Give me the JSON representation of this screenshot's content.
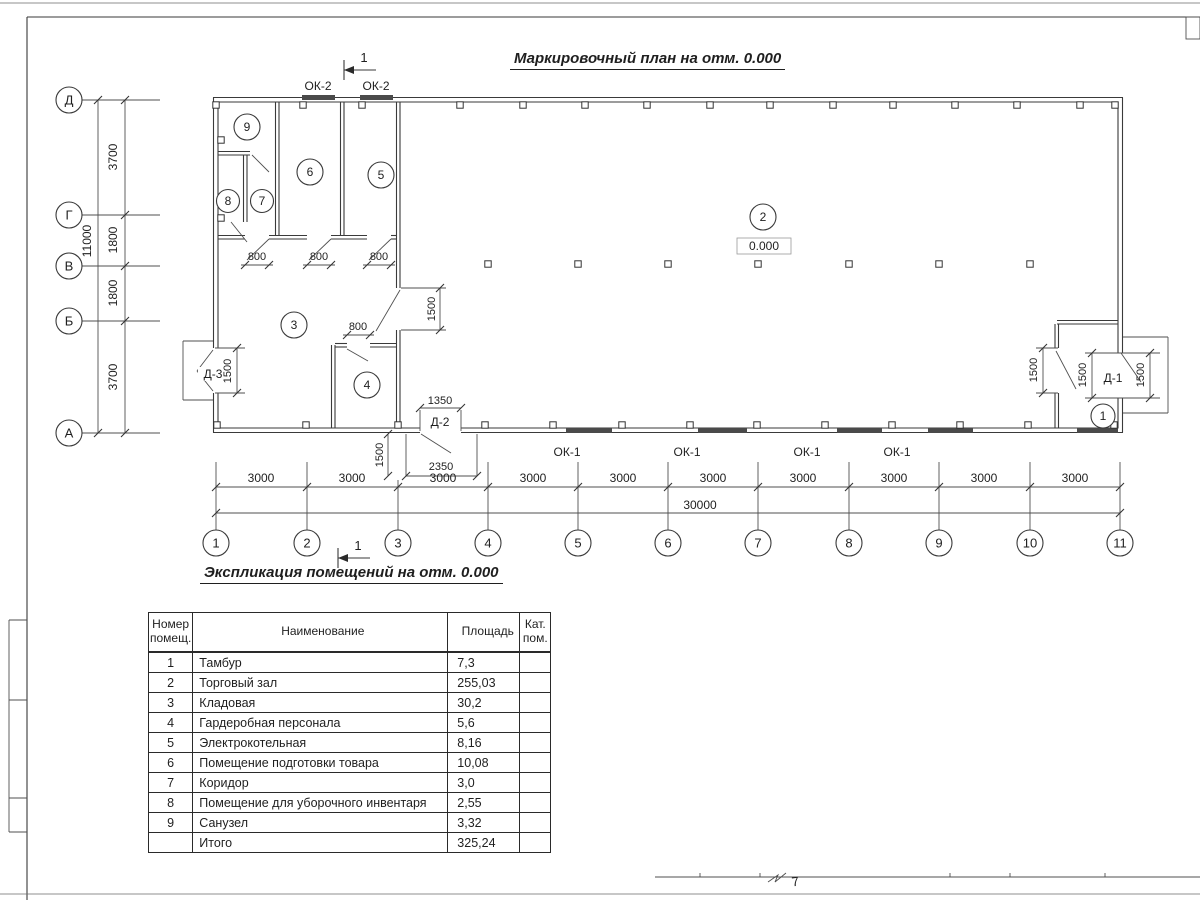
{
  "sheet": {
    "plan_title": "Маркировочный план на отм. 0.000",
    "table_title": "Экспликация помещений на отм. 0.000"
  },
  "marks": {
    "section": "1",
    "window_ok1": "ОК-1",
    "window_ok2": "ОК-2",
    "door_d1": "Д-1",
    "door_d2": "Д-2",
    "door_d3": "Д-3",
    "elevation": "0.000",
    "corner_note": "7"
  },
  "rooms": {
    "n1": "1",
    "n2": "2",
    "n3": "3",
    "n4": "4",
    "n5": "5",
    "n6": "6",
    "n7": "7",
    "n8": "8",
    "n9": "9"
  },
  "grid": {
    "cols": [
      "1",
      "2",
      "3",
      "4",
      "5",
      "6",
      "7",
      "8",
      "9",
      "10",
      "11"
    ],
    "rows": [
      "Д",
      "Г",
      "В",
      "Б",
      "А"
    ]
  },
  "dims": {
    "h_bay": "3000",
    "h_total": "30000",
    "v_total": "11000",
    "v1": "3700",
    "v2": "1800",
    "v3": "1800",
    "v4": "3700",
    "door": "800",
    "open": "1500",
    "d2_width": "1350",
    "d2_porch": "2350"
  },
  "table": {
    "headers": {
      "num": "Номер помещ.",
      "name": "Наименование",
      "area": "Площадь",
      "cat": "Кат. пом."
    },
    "rows": [
      {
        "num": "1",
        "name": "Тамбур",
        "area": "7,3",
        "cat": ""
      },
      {
        "num": "2",
        "name": "Торговый зал",
        "area": "255,03",
        "cat": ""
      },
      {
        "num": "3",
        "name": "Кладовая",
        "area": "30,2",
        "cat": ""
      },
      {
        "num": "4",
        "name": "Гардеробная персонала",
        "area": "5,6",
        "cat": ""
      },
      {
        "num": "5",
        "name": "Электрокотельная",
        "area": "8,16",
        "cat": ""
      },
      {
        "num": "6",
        "name": "Помещение подготовки товара",
        "area": "10,08",
        "cat": ""
      },
      {
        "num": "7",
        "name": "Коридор",
        "area": "3,0",
        "cat": ""
      },
      {
        "num": "8",
        "name": "Помещение для уборочного инвентаря",
        "area": "2,55",
        "cat": ""
      },
      {
        "num": "9",
        "name": "Санузел",
        "area": "3,32",
        "cat": ""
      },
      {
        "num": "",
        "name": "Итого",
        "area": "325,24",
        "cat": ""
      }
    ]
  },
  "colors": {
    "line": "#3a3a3a",
    "text": "#1f1f1f"
  }
}
